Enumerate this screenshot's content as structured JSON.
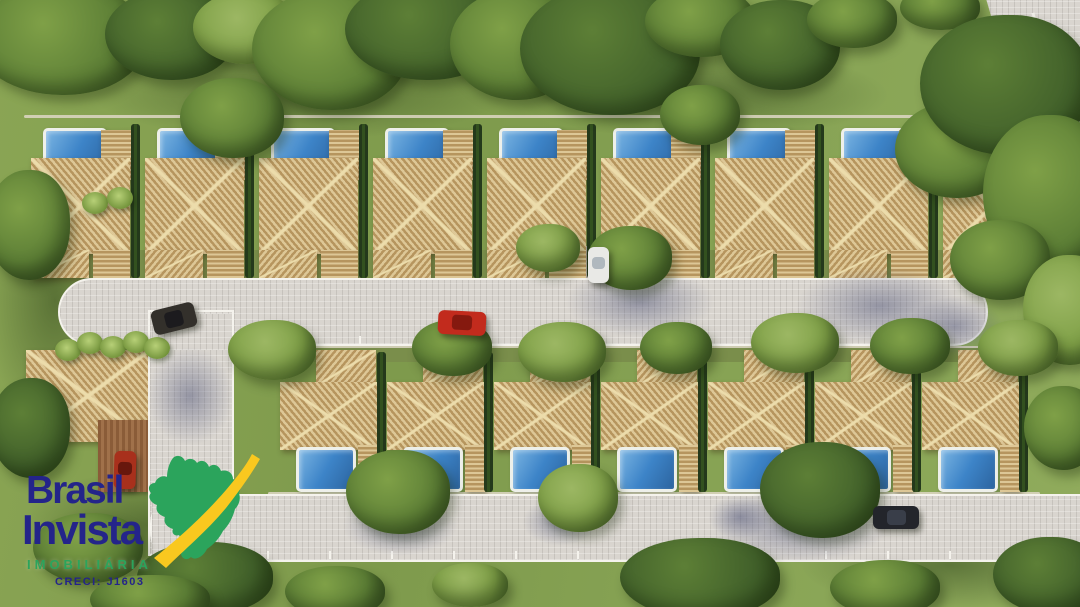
{
  "watermark": {
    "line1": "Brasil",
    "line2": "Invista",
    "subtitle": "IMOBILIÁRIA",
    "license": "CRECI: J1603",
    "colors": {
      "navy": "#24248a",
      "green": "#2ba45c",
      "yellow": "#f9c81f"
    }
  },
  "scene": {
    "description": "Aerial 3D rendering of a gated residential condominium: a top row of nine pool houses and a bottom row of seven pool houses with slatted wooden roofs along a central cul-de-sac street, entrance road and clubhouse with parking at the left, a perimeter road at the top right, dense trees and lawns all around.",
    "palette": {
      "grass": "#87a151",
      "grass-dark": "#6d8a40",
      "backyard": "#7a8e4b",
      "tree-dark": "#41602a",
      "tree-mid": "#5d7f36",
      "tree-light": "#7fa047",
      "tree-lighter": "#9cb763",
      "roof-light": "#ddc796",
      "roof-dark": "#b6955e",
      "ridge": "#ecdcab",
      "pool-hi": "#7ab4e2",
      "pool": "#3d84c8",
      "pool-lo": "#2c649f",
      "deck": "#eef0ea",
      "street": "#d9d5cf",
      "curb": "#f5f3ed",
      "hedge": "#2c4721",
      "wall": "#ded7c6",
      "wood": "#96683f"
    },
    "top_row": {
      "lots": [
        27,
        141,
        255,
        369,
        483,
        597,
        711,
        825,
        939
      ],
      "lot_w": 107,
      "pool": {
        "dx": 16,
        "y": 128,
        "w": 64,
        "h": 54
      },
      "pergola": {
        "dx": 74,
        "y": 130,
        "w": 30,
        "h": 50
      },
      "roof": {
        "dx": 4,
        "y": 158,
        "w": 99,
        "h": 96
      },
      "roof_ext": {
        "dx": 4,
        "y": 250,
        "w": 58,
        "h": 28
      },
      "patio": {
        "dx": 66,
        "y": 250,
        "w": 37,
        "h": 28
      },
      "hedge": {
        "dx": 104,
        "y": 124,
        "w": 9,
        "h": 154
      }
    },
    "bottom_row": {
      "lots": [
        280,
        387,
        494,
        601,
        708,
        815,
        922
      ],
      "lot_w": 100,
      "roof_ext": {
        "dx": 36,
        "y": 350,
        "w": 60,
        "h": 36
      },
      "roof": {
        "dx": 0,
        "y": 382,
        "w": 97,
        "h": 68
      },
      "pool": {
        "dx": 16,
        "y": 447,
        "w": 60,
        "h": 45
      },
      "pergola": {
        "dx": 78,
        "y": 445,
        "w": 20,
        "h": 47
      },
      "hedge": {
        "dx": 97,
        "y": 352,
        "w": 9,
        "h": 140
      }
    },
    "walls": [
      [
        24,
        115,
        1024,
        3
      ],
      [
        268,
        492,
        772,
        3
      ],
      [
        268,
        346,
        772,
        2
      ]
    ],
    "backyards": [
      [
        24,
        250,
        1024,
        28
      ],
      [
        230,
        346,
        830,
        16
      ]
    ],
    "driveway_pads": [
      [
        583,
        246,
        30,
        34
      ]
    ],
    "streets": {
      "mid": {
        "x": 58,
        "y": 278,
        "w": 930,
        "h": 68,
        "radius": "34px"
      },
      "vert": {
        "x": 148,
        "y": 310,
        "w": 86,
        "h": 246,
        "radius": "0"
      },
      "south": {
        "x": 150,
        "y": 494,
        "w": 940,
        "h": 68,
        "radius": "30px 0 0 30px"
      },
      "patches": [
        [
          152,
          314,
          78,
          36
        ],
        [
          152,
          498,
          78,
          58
        ]
      ],
      "perimeter": {
        "road": [
          960,
          0,
          120,
          230
        ],
        "clip": "polygon(22% 0, 100% 0, 100% 100%, 78% 100%)",
        "line": [
          1055,
          -5,
          3,
          225,
          -14
        ]
      }
    },
    "ticks": {
      "mid": {
        "y": 336,
        "x0": 245,
        "step": 57,
        "n": 13
      },
      "south": {
        "y": 551,
        "x0": 205,
        "step": 62,
        "n": 14
      }
    },
    "clubhouse": {
      "roof": [
        26,
        350,
        124,
        92
      ],
      "deck": [
        98,
        420,
        50,
        72
      ],
      "palms": [
        [
          68,
          350
        ],
        [
          90,
          343
        ],
        [
          113,
          347
        ],
        [
          136,
          342
        ],
        [
          157,
          348
        ],
        [
          95,
          203
        ],
        [
          120,
          198
        ]
      ]
    },
    "grass_shadows": [
      [
        300,
        95,
        210,
        45
      ],
      [
        700,
        95,
        190,
        45
      ],
      [
        150,
        525,
        130,
        55
      ],
      [
        950,
        565,
        150,
        45
      ],
      [
        55,
        300,
        70,
        130
      ]
    ],
    "trees": [
      [
        60,
        40,
        85,
        55,
        1
      ],
      [
        170,
        35,
        65,
        45,
        0
      ],
      [
        245,
        28,
        52,
        36,
        2
      ],
      [
        330,
        50,
        78,
        60,
        1
      ],
      [
        425,
        30,
        80,
        50,
        0
      ],
      [
        515,
        45,
        65,
        55,
        1
      ],
      [
        610,
        50,
        90,
        65,
        0
      ],
      [
        700,
        22,
        55,
        35,
        1
      ],
      [
        780,
        45,
        60,
        45,
        0
      ],
      [
        852,
        20,
        45,
        28,
        1
      ],
      [
        940,
        8,
        40,
        22,
        1
      ],
      [
        232,
        118,
        52,
        40,
        1
      ],
      [
        700,
        115,
        40,
        30,
        1
      ],
      [
        955,
        150,
        60,
        48,
        1
      ],
      [
        1005,
        85,
        85,
        70,
        0
      ],
      [
        1048,
        195,
        65,
        80,
        1
      ],
      [
        1000,
        260,
        50,
        40,
        1
      ],
      [
        1068,
        310,
        45,
        55,
        2
      ],
      [
        630,
        258,
        42,
        32,
        1
      ],
      [
        548,
        248,
        32,
        24,
        2
      ],
      [
        272,
        350,
        44,
        30,
        2
      ],
      [
        452,
        348,
        40,
        28,
        1
      ],
      [
        562,
        352,
        44,
        30,
        2
      ],
      [
        676,
        348,
        36,
        26,
        1
      ],
      [
        795,
        343,
        44,
        30,
        2
      ],
      [
        910,
        346,
        40,
        28,
        1
      ],
      [
        1018,
        348,
        40,
        28,
        2
      ],
      [
        398,
        492,
        52,
        42,
        1
      ],
      [
        578,
        498,
        40,
        34,
        2
      ],
      [
        820,
        490,
        60,
        48,
        0
      ],
      [
        205,
        578,
        68,
        36,
        0
      ],
      [
        335,
        592,
        50,
        26,
        1
      ],
      [
        470,
        585,
        38,
        22,
        2
      ],
      [
        700,
        578,
        80,
        40,
        0
      ],
      [
        885,
        588,
        55,
        28,
        1
      ],
      [
        1048,
        575,
        55,
        38,
        0
      ],
      [
        1062,
        428,
        38,
        42,
        1
      ],
      [
        28,
        225,
        42,
        55,
        1
      ],
      [
        30,
        428,
        40,
        50,
        0
      ],
      [
        88,
        548,
        55,
        35,
        1
      ],
      [
        150,
        600,
        60,
        25,
        1
      ]
    ],
    "street_shadows": [
      [
        640,
        302,
        75,
        36
      ],
      [
        880,
        306,
        85,
        40
      ],
      [
        955,
        326,
        48,
        30
      ],
      [
        1035,
        120,
        55,
        85
      ],
      [
        800,
        526,
        90,
        38
      ],
      [
        400,
        526,
        58,
        30
      ],
      [
        190,
        396,
        44,
        50
      ],
      [
        560,
        522,
        38,
        24
      ],
      [
        740,
        517,
        32,
        22
      ]
    ],
    "cars": [
      {
        "name": "suv-dark-entrance",
        "x": 152,
        "y": 306,
        "w": 44,
        "h": 25,
        "rot": -14,
        "body": "#33302b",
        "glass": "#1a191d"
      },
      {
        "name": "car-red-street",
        "x": 438,
        "y": 311,
        "w": 48,
        "h": 24,
        "rot": 3,
        "body": "#c22b1d",
        "glass": "#7e170e"
      },
      {
        "name": "car-white-driveway",
        "x": 588,
        "y": 247,
        "w": 21,
        "h": 36,
        "rot": 0,
        "body": "#e9e9e6",
        "glass": "#aab3b9"
      },
      {
        "name": "car-red-clubhouse",
        "x": 114,
        "y": 451,
        "w": 22,
        "h": 38,
        "rot": 2,
        "body": "#a8301c",
        "glass": "#5f150c"
      },
      {
        "name": "car-dark-south",
        "x": 873,
        "y": 506,
        "w": 46,
        "h": 23,
        "rot": 0,
        "body": "#23252b",
        "glass": "#3c414d"
      }
    ]
  }
}
